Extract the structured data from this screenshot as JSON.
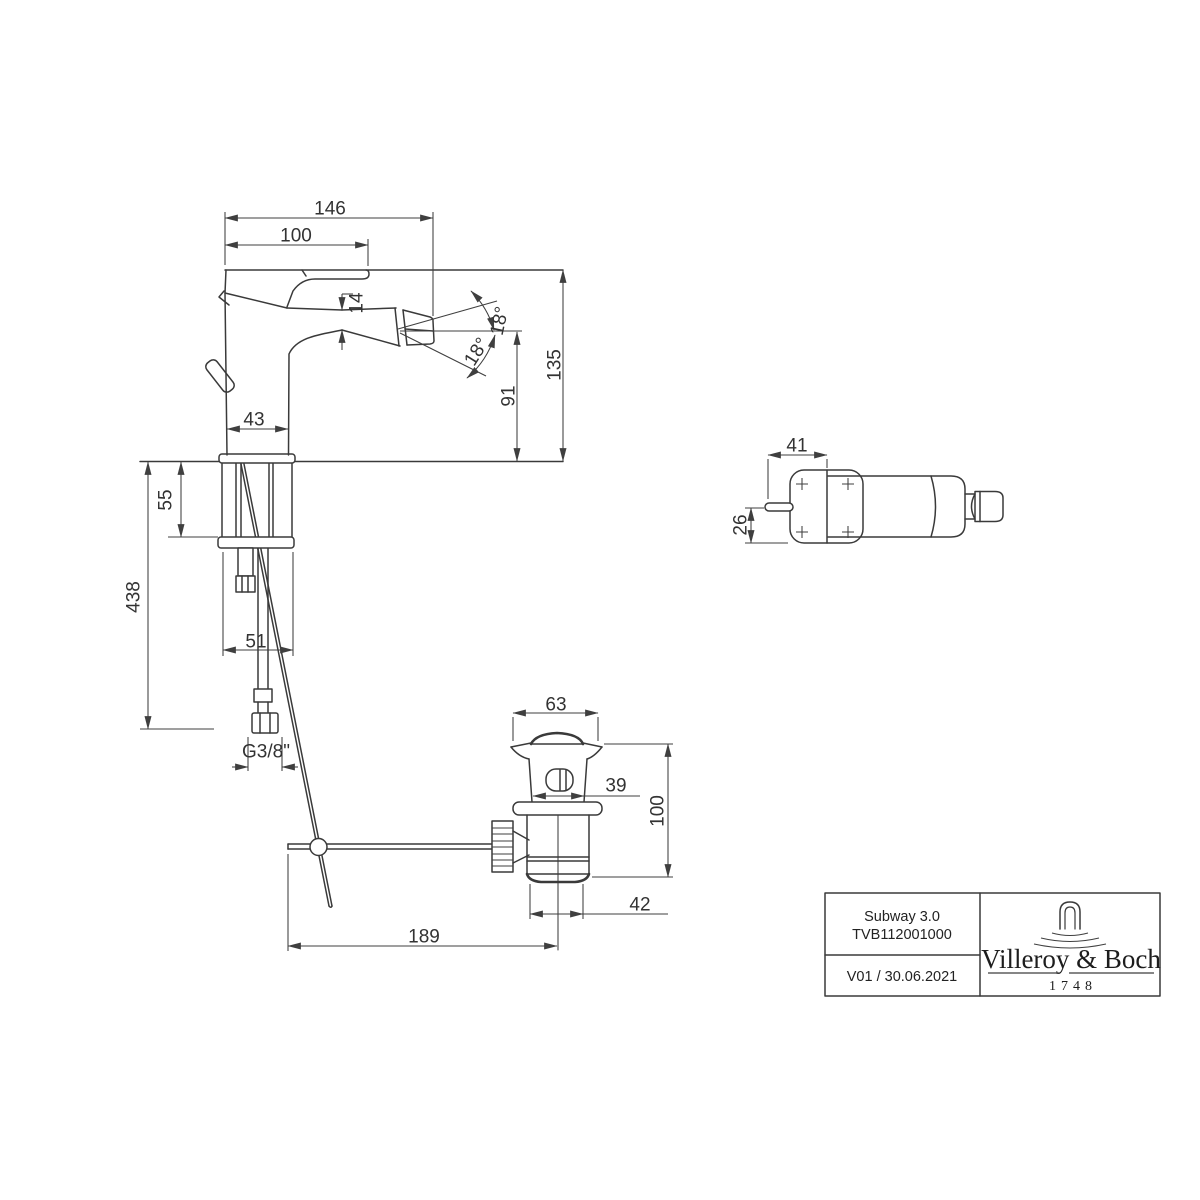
{
  "document": {
    "type": "technical-dimension-drawing",
    "product": "Subway 3.0",
    "article": "TVB112001000",
    "revision": "V01 / 30.06.2021"
  },
  "title_block": {
    "product": "Subway 3.0",
    "article": "TVB112001000",
    "revision": "V01 / 30.06.2021",
    "brand": "Villeroy & Boch",
    "brand_since": "1748",
    "logo": "villeroy-boch-arch-water-ripples-icon"
  },
  "dims": {
    "front": {
      "overall_depth": "146",
      "spout_reach": "100",
      "aerator_width": "14",
      "spray_angle_upper": "18°",
      "spray_angle_lower": "18°",
      "outlet_height": "91",
      "total_height": "135",
      "body_width": "43",
      "base_width": "51",
      "mount_depth": "55",
      "hose_length": "438",
      "thread": "G3/8\""
    },
    "top": {
      "handle_reach": "41",
      "handle_offset": "26"
    },
    "drain": {
      "flange_width": "63",
      "body_width": "39",
      "height": "100",
      "outlet_width": "42",
      "rod_length": "189"
    }
  },
  "colors": {
    "line": "#3a3a3a",
    "text": "#333333",
    "background": "#ffffff"
  }
}
